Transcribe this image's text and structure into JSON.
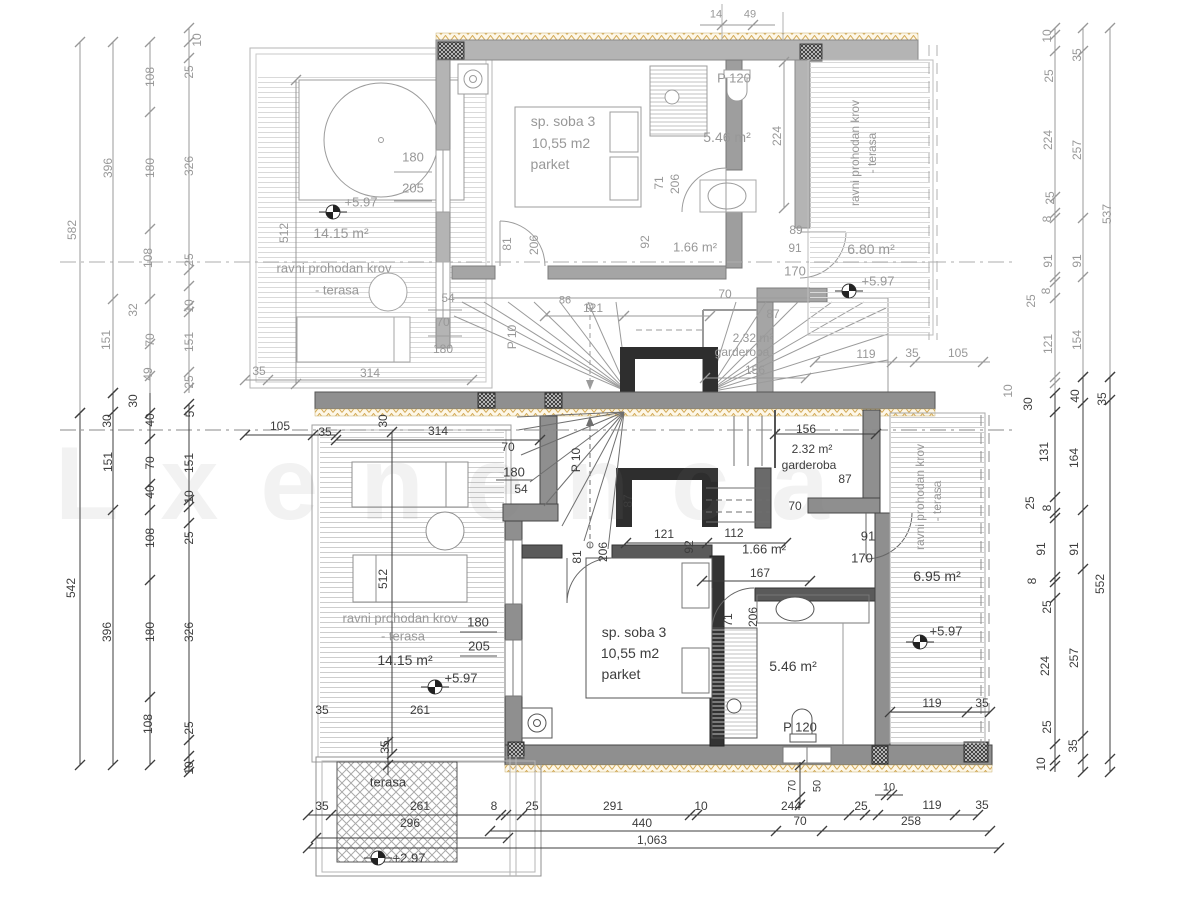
{
  "watermark": "Lxenenca",
  "colors": {
    "dim_gray": "#989898",
    "dim_dark": "#3d3d3d",
    "wall_upper": "#b4b4b4",
    "wall_lower": "#8f8f8f",
    "wall_black": "#2e2e2e",
    "insulation_hatch": "#cfa258",
    "terrace_hatch": "#d8d8d8"
  },
  "markers": [
    [
      333,
      212
    ],
    [
      849,
      291
    ],
    [
      435,
      687
    ],
    [
      920,
      642
    ],
    [
      378,
      858
    ]
  ],
  "labels": [
    [
      "10",
      197,
      40,
      1,
      "g"
    ],
    [
      "25",
      189,
      72,
      1,
      "g"
    ],
    [
      "108",
      150,
      77,
      1,
      "g"
    ],
    [
      "582",
      72,
      230,
      1,
      "g"
    ],
    [
      "396",
      108,
      168,
      1,
      "g"
    ],
    [
      "180",
      150,
      168,
      1,
      "g"
    ],
    [
      "326",
      189,
      166,
      1,
      "g"
    ],
    [
      "108",
      148,
      258,
      1,
      "g"
    ],
    [
      "25",
      189,
      260,
      1,
      "g"
    ],
    [
      "151",
      106,
      340,
      1,
      "g"
    ],
    [
      "32",
      133,
      310,
      1,
      "g"
    ],
    [
      "70",
      150,
      340,
      1,
      "g"
    ],
    [
      "49",
      148,
      374,
      1,
      "g"
    ],
    [
      "10",
      189,
      306,
      1,
      "g"
    ],
    [
      "151",
      189,
      342,
      1,
      "g"
    ],
    [
      "25",
      189,
      382,
      1,
      "g"
    ],
    [
      "30",
      107,
      421,
      1,
      "k"
    ],
    [
      "30",
      133,
      401,
      1,
      "k"
    ],
    [
      "40",
      150,
      420,
      1,
      "k"
    ],
    [
      "5",
      190,
      414,
      1,
      "k"
    ],
    [
      "151",
      108,
      462,
      1,
      "k"
    ],
    [
      "70",
      150,
      463,
      1,
      "k"
    ],
    [
      "151",
      189,
      463,
      1,
      "k"
    ],
    [
      "40",
      150,
      492,
      1,
      "k"
    ],
    [
      "10",
      189,
      497,
      1,
      "k"
    ],
    [
      "108",
      150,
      538,
      1,
      "k"
    ],
    [
      "25",
      189,
      538,
      1,
      "k"
    ],
    [
      "542",
      71,
      588,
      1,
      "k"
    ],
    [
      "396",
      107,
      632,
      1,
      "k"
    ],
    [
      "180",
      150,
      632,
      1,
      "k"
    ],
    [
      "326",
      189,
      632,
      1,
      "k"
    ],
    [
      "108",
      148,
      724,
      1,
      "k"
    ],
    [
      "25",
      189,
      728,
      1,
      "k"
    ],
    [
      "10",
      189,
      768,
      1,
      "k"
    ],
    [
      "10",
      1047,
      36,
      1,
      "g"
    ],
    [
      "25",
      1049,
      76,
      1,
      "g"
    ],
    [
      "35",
      1077,
      55,
      1,
      "g"
    ],
    [
      "224",
      1048,
      140,
      1,
      "g"
    ],
    [
      "257",
      1077,
      150,
      1,
      "g"
    ],
    [
      "537",
      1107,
      214,
      1,
      "g"
    ],
    [
      "25",
      1050,
      198,
      1,
      "g"
    ],
    [
      "8",
      1047,
      219,
      1,
      "g"
    ],
    [
      "91",
      1048,
      261,
      1,
      "g"
    ],
    [
      "91",
      1077,
      261,
      1,
      "g"
    ],
    [
      "8",
      1046,
      291,
      1,
      "g"
    ],
    [
      "25",
      1031,
      301,
      1,
      "g"
    ],
    [
      "121",
      1048,
      344,
      1,
      "g"
    ],
    [
      "154",
      1077,
      340,
      1,
      "g"
    ],
    [
      "10",
      1008,
      391,
      1,
      "g"
    ],
    [
      "30",
      1028,
      404,
      1,
      "k"
    ],
    [
      "40",
      1075,
      396,
      1,
      "k"
    ],
    [
      "35",
      1102,
      399,
      1,
      "k"
    ],
    [
      "131",
      1044,
      452,
      1,
      "k"
    ],
    [
      "164",
      1074,
      458,
      1,
      "k"
    ],
    [
      "25",
      1030,
      503,
      1,
      "k"
    ],
    [
      "8",
      1047,
      508,
      1,
      "k"
    ],
    [
      "91",
      1041,
      549,
      1,
      "k"
    ],
    [
      "91",
      1074,
      549,
      1,
      "k"
    ],
    [
      "8",
      1032,
      581,
      1,
      "k"
    ],
    [
      "552",
      1100,
      584,
      1,
      "k"
    ],
    [
      "25",
      1047,
      607,
      1,
      "k"
    ],
    [
      "224",
      1045,
      666,
      1,
      "k"
    ],
    [
      "257",
      1074,
      658,
      1,
      "k"
    ],
    [
      "25",
      1047,
      727,
      1,
      "k"
    ],
    [
      "35",
      1073,
      746,
      1,
      "k"
    ],
    [
      "10",
      1041,
      764,
      1,
      "k"
    ],
    [
      "sp. soba 3",
      563,
      121,
      0,
      "g",
      14
    ],
    [
      "10,55 m2",
      561,
      143,
      0,
      "g",
      14
    ],
    [
      "parket",
      550,
      164,
      0,
      "g",
      14
    ],
    [
      "P 120",
      734,
      78,
      0,
      "g",
      13
    ],
    [
      "5.46 m²",
      727,
      137,
      0,
      "g",
      14
    ],
    [
      "1.66 m²",
      695,
      247,
      0,
      "g",
      13
    ],
    [
      "92",
      645,
      242,
      1,
      "g"
    ],
    [
      "71",
      659,
      183,
      1,
      "g"
    ],
    [
      "206",
      675,
      184,
      1,
      "g"
    ],
    [
      "224",
      777,
      136,
      1,
      "g"
    ],
    [
      "6.80 m²",
      871,
      249,
      0,
      "g",
      14
    ],
    [
      "+5.97",
      878,
      281,
      0,
      "g",
      13
    ],
    [
      "ravni prohodan krov",
      855,
      153,
      1,
      "g"
    ],
    [
      "- terasa",
      872,
      153,
      1,
      "g"
    ],
    [
      "89",
      796,
      230,
      0,
      "g"
    ],
    [
      "91",
      795,
      248,
      0,
      "g"
    ],
    [
      "170",
      795,
      271,
      0,
      "g",
      13
    ],
    [
      "2.32 m²",
      753,
      338,
      0,
      "g"
    ],
    [
      "garderoba",
      742,
      352,
      0,
      "g"
    ],
    [
      "156",
      755,
      370,
      0,
      "g"
    ],
    [
      "87",
      773,
      314,
      0,
      "g"
    ],
    [
      "70",
      725,
      294,
      0,
      "g"
    ],
    [
      "P 10",
      512,
      337,
      1,
      "g"
    ],
    [
      "86",
      565,
      301,
      0,
      "g",
      11
    ],
    [
      "121",
      593,
      308,
      0,
      "g"
    ],
    [
      "54",
      448,
      298,
      0,
      "g"
    ],
    [
      "70",
      443,
      322,
      0,
      "g"
    ],
    [
      "180",
      443,
      349,
      0,
      "g"
    ],
    [
      "180",
      413,
      157,
      0,
      "g",
      13
    ],
    [
      "205",
      413,
      188,
      0,
      "g",
      13
    ],
    [
      "81",
      507,
      244,
      1,
      "g"
    ],
    [
      "206",
      534,
      245,
      1,
      "g"
    ],
    [
      "+5.97",
      361,
      202,
      0,
      "g",
      13
    ],
    [
      "14.15 m²",
      341,
      233,
      0,
      "g",
      14
    ],
    [
      "ravni prohodan krov",
      334,
      268,
      0,
      "g",
      13
    ],
    [
      "- terasa",
      337,
      290,
      0,
      "g",
      13
    ],
    [
      "512",
      284,
      233,
      1,
      "g"
    ],
    [
      "35",
      259,
      371,
      0,
      "g"
    ],
    [
      "314",
      370,
      373,
      0,
      "g"
    ],
    [
      "119",
      866,
      354,
      0,
      "g"
    ],
    [
      "35",
      912,
      353,
      0,
      "g"
    ],
    [
      "105",
      958,
      353,
      0,
      "g"
    ],
    [
      "14",
      716,
      15,
      0,
      "g",
      11
    ],
    [
      "49",
      750,
      15,
      0,
      "g",
      11
    ],
    [
      "105",
      280,
      426,
      0,
      "k"
    ],
    [
      "35",
      325,
      432,
      0,
      "k"
    ],
    [
      "314",
      438,
      431,
      0,
      "k"
    ],
    [
      "30",
      383,
      421,
      1,
      "k"
    ],
    [
      "70",
      508,
      447,
      0,
      "k"
    ],
    [
      "180",
      514,
      472,
      0,
      "k",
      13
    ],
    [
      "54",
      521,
      489,
      0,
      "k"
    ],
    [
      "P 10",
      576,
      460,
      1,
      "k"
    ],
    [
      "87",
      628,
      501,
      1,
      "k"
    ],
    [
      "121",
      664,
      534,
      0,
      "k"
    ],
    [
      "112",
      734,
      533,
      0,
      "k"
    ],
    [
      "1.66 m²",
      764,
      549,
      0,
      "k",
      13
    ],
    [
      "92",
      689,
      547,
      1,
      "k"
    ],
    [
      "167",
      760,
      573,
      0,
      "k"
    ],
    [
      "156",
      806,
      429,
      0,
      "k"
    ],
    [
      "2.32 m²",
      812,
      449,
      0,
      "k"
    ],
    [
      "garderoba",
      809,
      465,
      0,
      "k"
    ],
    [
      "87",
      845,
      479,
      0,
      "k"
    ],
    [
      "70",
      795,
      506,
      0,
      "k"
    ],
    [
      "91",
      868,
      536,
      0,
      "k",
      13
    ],
    [
      "170",
      862,
      558,
      0,
      "k",
      13
    ],
    [
      "6.95 m²",
      937,
      576,
      0,
      "k",
      14
    ],
    [
      "ravni prohodan krov",
      920,
      497,
      1,
      "g"
    ],
    [
      "- terasa",
      937,
      501,
      1,
      "g"
    ],
    [
      "+5.97",
      946,
      631,
      0,
      "k",
      13
    ],
    [
      "119",
      932,
      703,
      0,
      "k"
    ],
    [
      "35",
      982,
      703,
      0,
      "k"
    ],
    [
      "sp. soba 3",
      634,
      632,
      0,
      "k",
      14
    ],
    [
      "10,55 m2",
      630,
      653,
      0,
      "k",
      14
    ],
    [
      "parket",
      621,
      674,
      0,
      "k",
      14
    ],
    [
      "71",
      728,
      620,
      1,
      "k"
    ],
    [
      "206",
      753,
      617,
      1,
      "k"
    ],
    [
      "5.46 m²",
      793,
      666,
      0,
      "k",
      14
    ],
    [
      "P 120",
      800,
      727,
      0,
      "k",
      13
    ],
    [
      "81",
      577,
      557,
      1,
      "k"
    ],
    [
      "206",
      603,
      552,
      1,
      "k"
    ],
    [
      "180",
      478,
      622,
      0,
      "k",
      13
    ],
    [
      "205",
      479,
      646,
      0,
      "k",
      13
    ],
    [
      "14.15 m²",
      405,
      660,
      0,
      "k",
      14
    ],
    [
      "+5.97",
      461,
      678,
      0,
      "k",
      13
    ],
    [
      "261",
      420,
      710,
      0,
      "k"
    ],
    [
      "ravni prohodan krov",
      400,
      618,
      0,
      "g",
      13
    ],
    [
      "- terasa",
      403,
      636,
      0,
      "g",
      13
    ],
    [
      "512",
      383,
      579,
      1,
      "k"
    ],
    [
      "35",
      322,
      710,
      0,
      "k"
    ],
    [
      "35",
      385,
      747,
      1,
      "k"
    ],
    [
      "terasa",
      388,
      782,
      0,
      "k",
      13
    ],
    [
      "+2.97",
      409,
      858,
      0,
      "k",
      13
    ],
    [
      "35",
      322,
      806,
      0,
      "k"
    ],
    [
      "261",
      420,
      806,
      0,
      "k"
    ],
    [
      "296",
      410,
      823,
      0,
      "k"
    ],
    [
      "8",
      494,
      806,
      0,
      "k"
    ],
    [
      "25",
      532,
      806,
      0,
      "k"
    ],
    [
      "291",
      613,
      806,
      0,
      "k"
    ],
    [
      "10",
      701,
      806,
      0,
      "k"
    ],
    [
      "244",
      791,
      806,
      0,
      "k"
    ],
    [
      "70",
      793,
      786,
      1,
      "k",
      11
    ],
    [
      "50",
      818,
      786,
      1,
      "k",
      11
    ],
    [
      "25",
      861,
      806,
      0,
      "k"
    ],
    [
      "10",
      889,
      788,
      0,
      "k",
      11
    ],
    [
      "119",
      932,
      805,
      0,
      "k"
    ],
    [
      "35",
      982,
      805,
      0,
      "k"
    ],
    [
      "440",
      642,
      823,
      0,
      "k"
    ],
    [
      "70",
      800,
      821,
      0,
      "k"
    ],
    [
      "258",
      911,
      821,
      0,
      "k"
    ],
    [
      "1,063",
      652,
      840,
      0,
      "k"
    ]
  ],
  "chains": [
    {
      "d": "v",
      "p": 80,
      "a": 42,
      "b": 413,
      "c": "g",
      "t": [
        42,
        413
      ]
    },
    {
      "d": "v",
      "p": 80,
      "a": 413,
      "b": 765,
      "c": "k",
      "t": [
        413,
        765
      ]
    },
    {
      "d": "v",
      "p": 113,
      "a": 42,
      "b": 393,
      "c": "g",
      "t": [
        42,
        299,
        393
      ]
    },
    {
      "d": "v",
      "p": 113,
      "a": 393,
      "b": 765,
      "c": "k",
      "t": [
        393,
        412,
        510,
        765
      ]
    },
    {
      "d": "v",
      "p": 150,
      "a": 42,
      "b": 393,
      "c": "g",
      "t": [
        42,
        112,
        229,
        299,
        344,
        376
      ]
    },
    {
      "d": "v",
      "p": 150,
      "a": 393,
      "b": 765,
      "c": "k",
      "t": [
        413,
        439,
        484,
        510,
        580,
        697,
        765
      ]
    },
    {
      "d": "v",
      "p": 189,
      "a": 28,
      "b": 393,
      "c": "g",
      "t": [
        28,
        42,
        58,
        270,
        286,
        306,
        312,
        372,
        388
      ]
    },
    {
      "d": "v",
      "p": 189,
      "a": 404,
      "b": 772,
      "c": "k",
      "t": [
        404,
        410,
        500,
        507,
        523,
        740,
        756,
        765,
        772
      ]
    },
    {
      "d": "v",
      "p": 296,
      "a": 80,
      "b": 384,
      "c": "g",
      "t": [
        80,
        384
      ]
    },
    {
      "d": "v",
      "p": 392,
      "a": 432,
      "b": 754,
      "c": "k",
      "t": [
        432,
        754
      ]
    },
    {
      "d": "v",
      "p": 1055,
      "a": 28,
      "b": 393,
      "c": "g",
      "t": [
        28,
        35,
        51,
        197,
        213,
        218,
        277,
        282,
        298,
        377,
        383
      ]
    },
    {
      "d": "v",
      "p": 1055,
      "a": 393,
      "b": 772,
      "c": "k",
      "t": [
        393,
        412,
        497,
        513,
        518,
        577,
        582,
        598,
        744,
        760,
        766
      ]
    },
    {
      "d": "v",
      "p": 1083,
      "a": 28,
      "b": 377,
      "c": "g",
      "t": [
        28,
        51,
        218,
        277,
        377
      ]
    },
    {
      "d": "v",
      "p": 1083,
      "a": 377,
      "b": 772,
      "c": "k",
      "t": [
        377,
        403,
        510,
        569,
        736,
        759,
        772
      ]
    },
    {
      "d": "v",
      "p": 1110,
      "a": 28,
      "b": 377,
      "c": "g",
      "t": [
        28,
        377
      ]
    },
    {
      "d": "v",
      "p": 1110,
      "a": 377,
      "b": 772,
      "c": "k",
      "t": [
        377,
        400,
        759,
        772
      ]
    },
    {
      "d": "h",
      "p": 815,
      "a": 308,
      "b": 978,
      "c": "k",
      "t": [
        308,
        331,
        501,
        506,
        522,
        690,
        697,
        849,
        865,
        878,
        955,
        978
      ]
    },
    {
      "d": "h",
      "p": 831,
      "a": 490,
      "b": 990,
      "c": "k",
      "t": [
        490,
        776,
        822,
        990
      ]
    },
    {
      "d": "h",
      "p": 838,
      "a": 316,
      "b": 508,
      "c": "k",
      "t": [
        316,
        508
      ]
    },
    {
      "d": "h",
      "p": 848,
      "a": 308,
      "b": 999,
      "c": "k",
      "t": [
        308,
        999
      ]
    },
    {
      "d": "h",
      "p": 795,
      "a": 875,
      "b": 903,
      "c": "k",
      "t": [
        886,
        892
      ]
    },
    {
      "d": "v",
      "p": 388,
      "a": 737,
      "b": 775,
      "c": "k",
      "t": [
        742,
        765
      ]
    },
    {
      "d": "v",
      "p": 800,
      "a": 762,
      "b": 808,
      "c": "k",
      "t": [
        765,
        797,
        805
      ]
    },
    {
      "d": "h",
      "p": 362,
      "a": 815,
      "b": 990,
      "c": "g",
      "t": [
        815,
        892,
        915,
        983
      ]
    },
    {
      "d": "h",
      "p": 380,
      "a": 245,
      "b": 472,
      "c": "g",
      "t": [
        245,
        268,
        472
      ]
    },
    {
      "d": "h",
      "p": 435,
      "a": 245,
      "b": 336,
      "c": "k",
      "t": [
        245,
        313,
        336
      ]
    },
    {
      "d": "h",
      "p": 440,
      "a": 336,
      "b": 540,
      "c": "k",
      "t": [
        336,
        540
      ]
    },
    {
      "d": "h",
      "p": 316,
      "a": 545,
      "b": 710,
      "c": "g",
      "t": [
        545,
        624,
        710
      ]
    },
    {
      "d": "h",
      "p": 543,
      "a": 626,
      "b": 786,
      "c": "k",
      "t": [
        626,
        707,
        786
      ]
    },
    {
      "d": "h",
      "p": 581,
      "a": 702,
      "b": 810,
      "c": "k",
      "t": [
        702,
        810
      ]
    },
    {
      "d": "v",
      "p": 784,
      "a": 62,
      "b": 208,
      "c": "g",
      "t": [
        62,
        208
      ]
    },
    {
      "d": "h",
      "p": 712,
      "a": 890,
      "b": 990,
      "c": "k",
      "t": [
        890,
        967,
        990
      ]
    },
    {
      "d": "h",
      "p": 434,
      "a": 775,
      "b": 876,
      "c": "k",
      "t": [
        775,
        876
      ]
    },
    {
      "d": "h",
      "p": 378,
      "a": 705,
      "b": 806,
      "c": "g",
      "t": [
        705,
        806
      ]
    },
    {
      "d": "h",
      "p": 25,
      "a": 700,
      "b": 775,
      "c": "g",
      "t": [
        722,
        753
      ]
    }
  ]
}
